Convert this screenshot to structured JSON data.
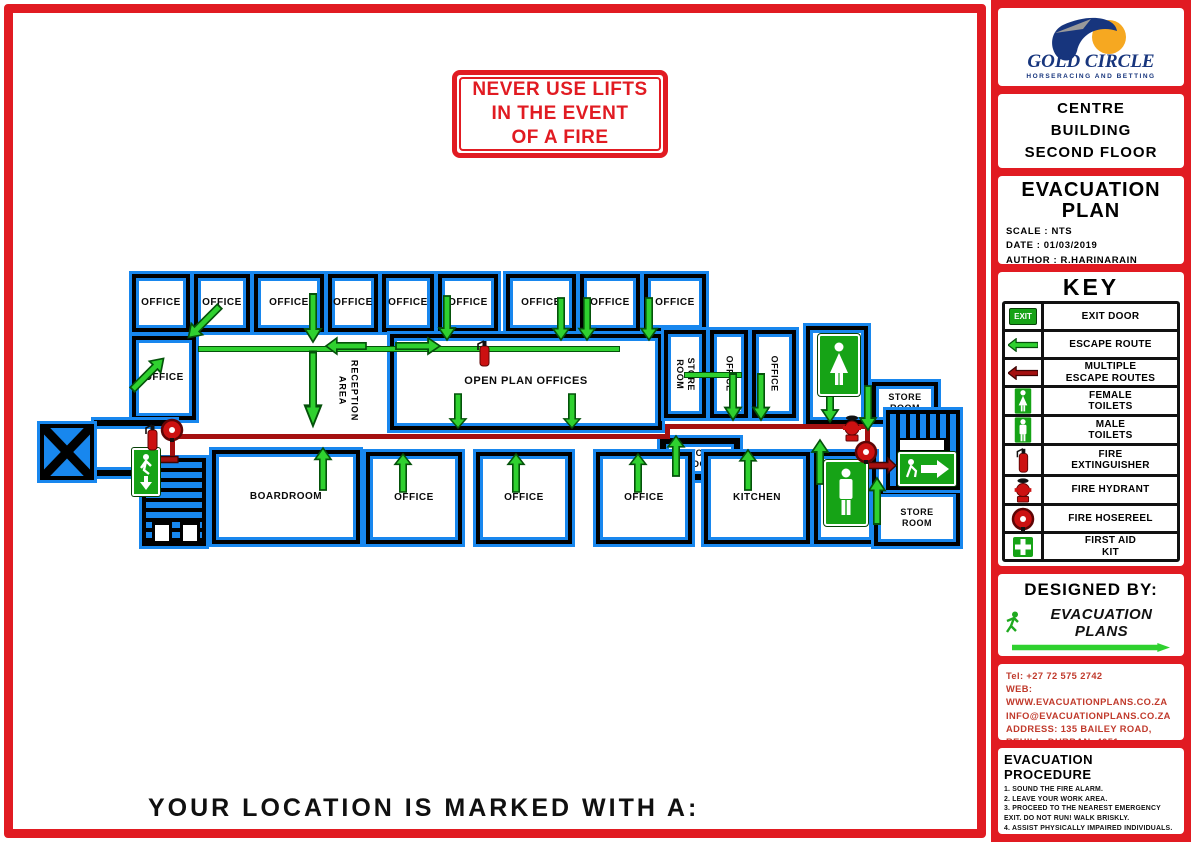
{
  "page": {
    "footer_note": "YOUR LOCATION IS MARKED WITH A:"
  },
  "warning": {
    "text": "NEVER USE LIFTS\nIN THE EVENT\nOF A FIRE"
  },
  "sidebar": {
    "logo": {
      "brand": "GOLD CIRCLE",
      "tagline": "HORSERACING AND BETTING"
    },
    "building": "CENTRE\nBUILDING\nSECOND FLOOR",
    "plan_info": {
      "title": "EVACUATION\nPLAN",
      "scale": "SCALE : NTS",
      "date": "DATE : 01/03/2019",
      "author": "AUTHOR : R.HARINARAIN"
    },
    "key": {
      "title": "KEY",
      "exit_text": "EXIT",
      "items": [
        {
          "icon": "exit-door",
          "label": "EXIT DOOR"
        },
        {
          "icon": "escape-route",
          "label": "ESCAPE ROUTE"
        },
        {
          "icon": "multiple-escape-routes",
          "label": "MULTIPLE\nESCAPE ROUTES"
        },
        {
          "icon": "female-toilets",
          "label": "FEMALE\nTOILETS"
        },
        {
          "icon": "male-toilets",
          "label": "MALE\nTOILETS"
        },
        {
          "icon": "fire-extinguisher",
          "label": "FIRE\nEXTINGUISHER"
        },
        {
          "icon": "fire-hydrant",
          "label": "FIRE HYDRANT"
        },
        {
          "icon": "fire-hosereel",
          "label": "FIRE HOSEREEL"
        },
        {
          "icon": "first-aid-kit",
          "label": "FIRST AID\nKIT"
        }
      ]
    },
    "designed_by": {
      "heading": "DESIGNED BY:",
      "brand": "EVACUATION PLANS"
    },
    "contact": {
      "tel": "Tel: +27 72 575 2742",
      "web": "WEB: WWW.EVACUATIONPLANS.CO.ZA",
      "email": "INFO@EVACUATIONPLANS.CO.ZA",
      "address_line1": "ADDRESS: 135 BAILEY ROAD,",
      "address_line2": "REHILL, DURBAN, 4051"
    },
    "procedure": {
      "title": "EVACUATION PROCEDURE",
      "steps": [
        "1. SOUND THE FIRE ALARM.",
        "2. LEAVE YOUR WORK AREA.",
        "3. PROCEED TO THE NEAREST EMERGENCY EXIT. DO NOT RUN! WALK BRISKLY.",
        "4. ASSIST PHYSICALLY IMPAIRED INDIVIDUALS.",
        "5. PROCEED TO THE ASSEMBLY POINT LOCATED OUTSIDE."
      ]
    }
  },
  "plan": {
    "top_offices": [
      "OFFICE",
      "OFFICE",
      "OFFICE",
      "OFFICE",
      "OFFICE",
      "OFFICE",
      "OFFICE",
      "OFFICE",
      "OFFICE"
    ],
    "left_office": "OFFICE",
    "reception": "RECEPTION\nAREA",
    "open_plan": "OPEN PLAN OFFICES",
    "store_room_vertical": "STORE\nROOM",
    "office_vertical_1": "OFFICE",
    "office_vertical_2": "OFFICE",
    "store_room_top_right": "STORE\nROOM",
    "store_room_center": "STORE\nROOM",
    "boardroom": "BOARDROOM",
    "bottom_offices": [
      "OFFICE",
      "OFFICE",
      "OFFICE"
    ],
    "kitchen": "KITCHEN",
    "store_room_bottom_right": "STORE\nROOM"
  },
  "colors": {
    "frame_red": "#e11b22",
    "wall_blue": "#1887ee",
    "wall_black": "#000000",
    "route_green": "#2fd12f",
    "route_dark_red": "#a51010",
    "sign_green": "#16a316",
    "logo_navy": "#17357d",
    "logo_orange": "#f6a821"
  }
}
